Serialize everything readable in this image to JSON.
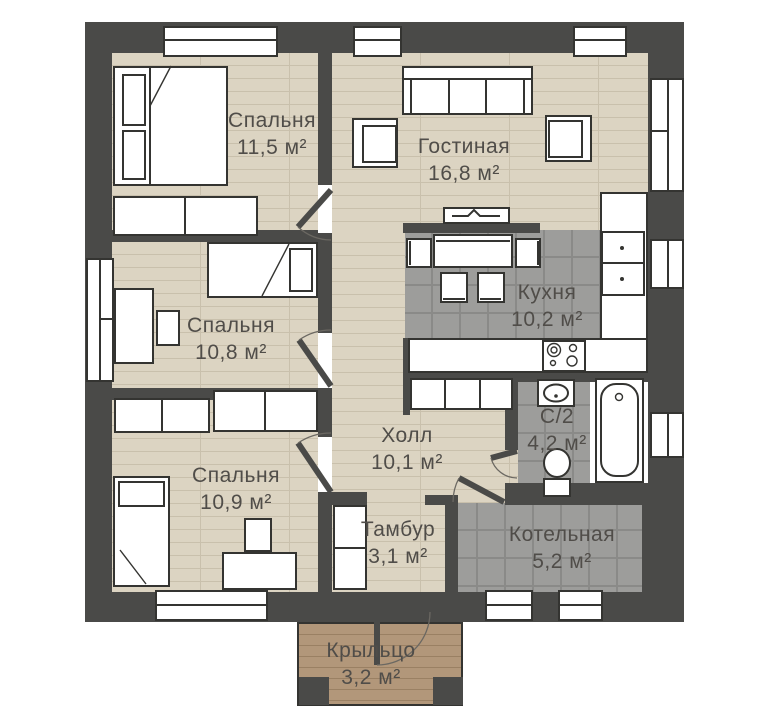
{
  "plan_title": "Одноэтажный дом — план этажа",
  "rooms": [
    {
      "id": "bedroom-1",
      "name": "Спальня",
      "area": "11,5 м²"
    },
    {
      "id": "living-room",
      "name": "Гостиная",
      "area": "16,8 м²"
    },
    {
      "id": "kitchen",
      "name": "Кухня",
      "area": "10,2 м²"
    },
    {
      "id": "bedroom-2",
      "name": "Спальня",
      "area": "10,8 м²"
    },
    {
      "id": "hall",
      "name": "Холл",
      "area": "10,1 м²"
    },
    {
      "id": "bathroom",
      "name": "С/2",
      "area": "4,2 м²"
    },
    {
      "id": "bedroom-3",
      "name": "Спальня",
      "area": "10,9 м²"
    },
    {
      "id": "vestibule",
      "name": "Тамбур",
      "area": "3,1 м²"
    },
    {
      "id": "boiler-room",
      "name": "Котельная",
      "area": "5,2 м²"
    },
    {
      "id": "porch",
      "name": "Крыльцо",
      "area": "3,2 м²"
    }
  ],
  "colors": {
    "wall": "#4a4a48",
    "wood_floor": "#dcd4c2",
    "wood_line": "#c9c0ac",
    "tile_floor": "#9d9d9b",
    "tile_line": "#8a8a88",
    "porch_floor": "#b2977a",
    "porch_line": "#9a8063",
    "furniture_fill": "#ffffff",
    "outline": "#343431",
    "label_text": "#504d49"
  }
}
